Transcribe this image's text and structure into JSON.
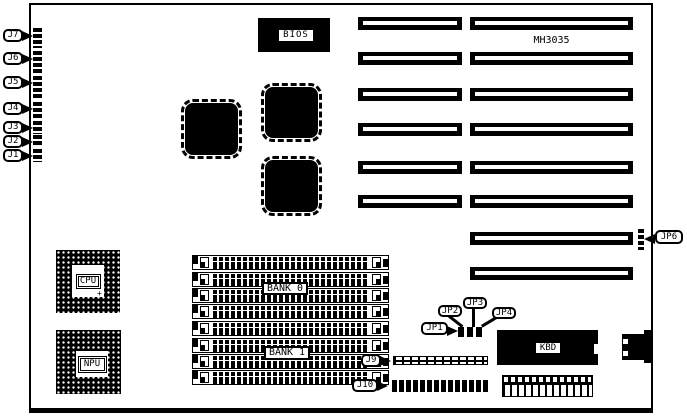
{
  "diagram": {
    "model": "MH3035",
    "chips": {
      "bios": "BIOS",
      "cpu": "CPU",
      "npu": "NPU",
      "kbd": "KBD"
    },
    "memory": {
      "bank0": "BANK 0",
      "bank1": "BANK 1"
    },
    "callouts": {
      "j1": "J1",
      "j2": "J2",
      "j3": "J3",
      "j4": "J4",
      "j5": "J5",
      "j6": "J6",
      "j7": "J7",
      "j9": "J9",
      "j10": "J10",
      "jp1": "JP1",
      "jp2": "JP2",
      "jp3": "JP3",
      "jp4": "JP4",
      "jp6": "JP6"
    },
    "markers": {
      "cpu_pin1": "+"
    },
    "colors": {
      "ink": "#000000",
      "board": "#ffffff"
    }
  }
}
